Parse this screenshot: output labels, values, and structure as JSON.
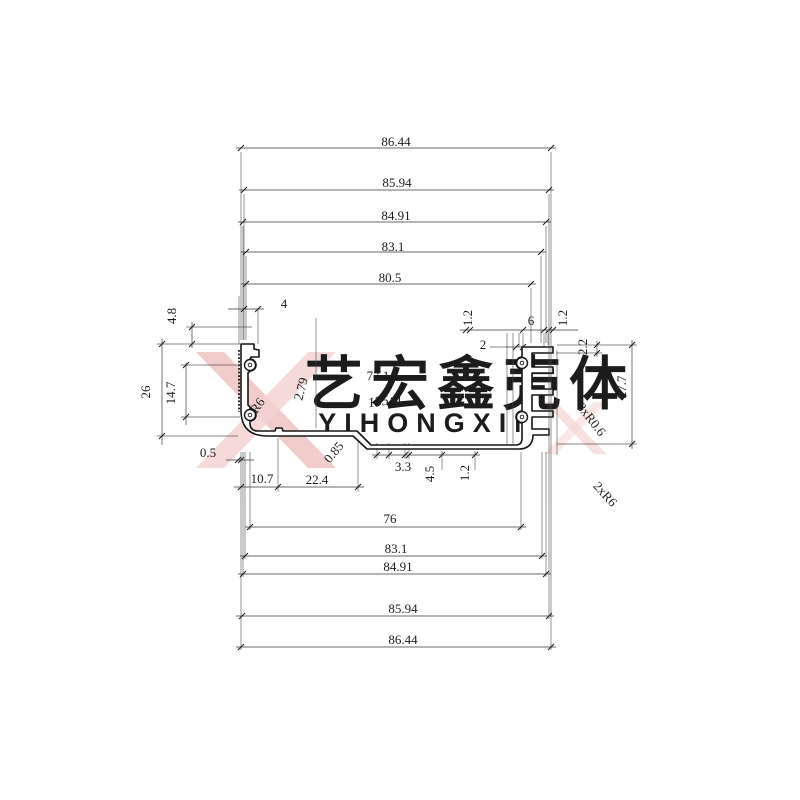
{
  "watermark": {
    "cn": "艺宏鑫壳体",
    "en": "YIHONGXIN"
  },
  "colors": {
    "line": "#1c1c1c",
    "thin_line": "#4a4a4a",
    "watermark_pink": "#f0c2c2",
    "watermark_pink_light": "#f5d2d2",
    "watermark_gray": "#e4e6ec"
  },
  "dims": {
    "top": [
      "86.44",
      "85.94",
      "84.91",
      "83.1",
      "80.5"
    ],
    "bottom": [
      "76",
      "83.1",
      "84.91",
      "85.94",
      "86.44"
    ],
    "labels": {
      "d4": "4",
      "d48": "4.8",
      "d12a": "1.2",
      "d6": "6",
      "d12b": "1.2",
      "d2": "2",
      "d22": "2.2",
      "d277": "27.7",
      "d26": "26",
      "d147": "14.7",
      "d05": "0.5",
      "d771": "77.1",
      "d135": "135¡ã",
      "r6": "R6",
      "d279": "2.79",
      "d085": "0.85",
      "d107": "10.7",
      "d224": "22.4",
      "d33": "3.3",
      "d45": "4.5",
      "d12c": "1.2",
      "fins": "8xR0.6",
      "corners": "2xR6"
    }
  }
}
